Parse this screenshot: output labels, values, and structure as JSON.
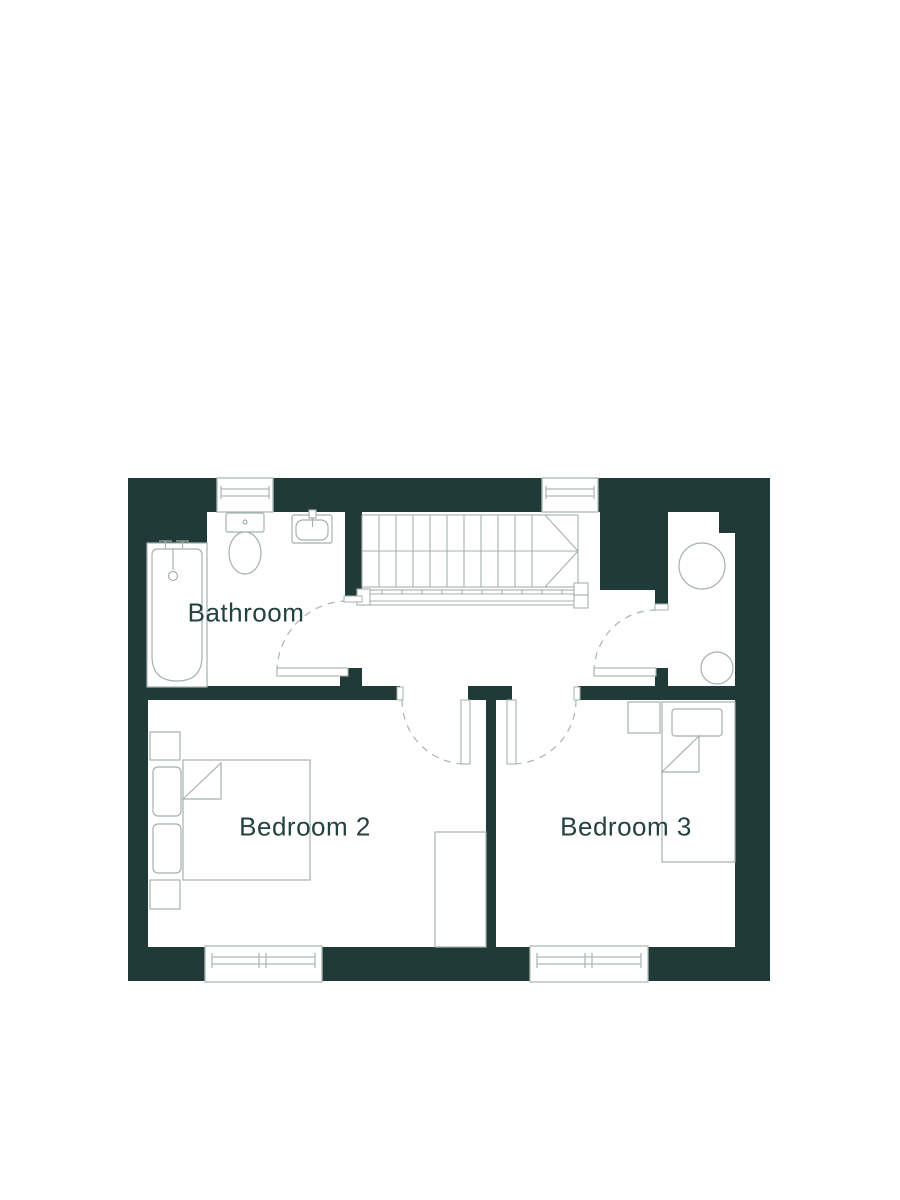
{
  "floor_plan": {
    "rooms": [
      {
        "name": "Bathroom"
      },
      {
        "name": "Bedroom 2"
      },
      {
        "name": "Bedroom 3"
      }
    ],
    "fixtures": [
      "bathtub",
      "toilet",
      "basin",
      "staircase",
      "handrail",
      "cupboard-cylinder-large",
      "cupboard-cylinder-small",
      "double-bed",
      "single-bed",
      "wardrobe",
      "bedside-tables"
    ],
    "window_count": 4,
    "door_count": 4,
    "colors": {
      "wall": "#203b37",
      "furniture_line": "#a5b1ae",
      "window_frame": "#aebab7",
      "floor": "#ffffff",
      "label_text": "#24423e"
    }
  }
}
